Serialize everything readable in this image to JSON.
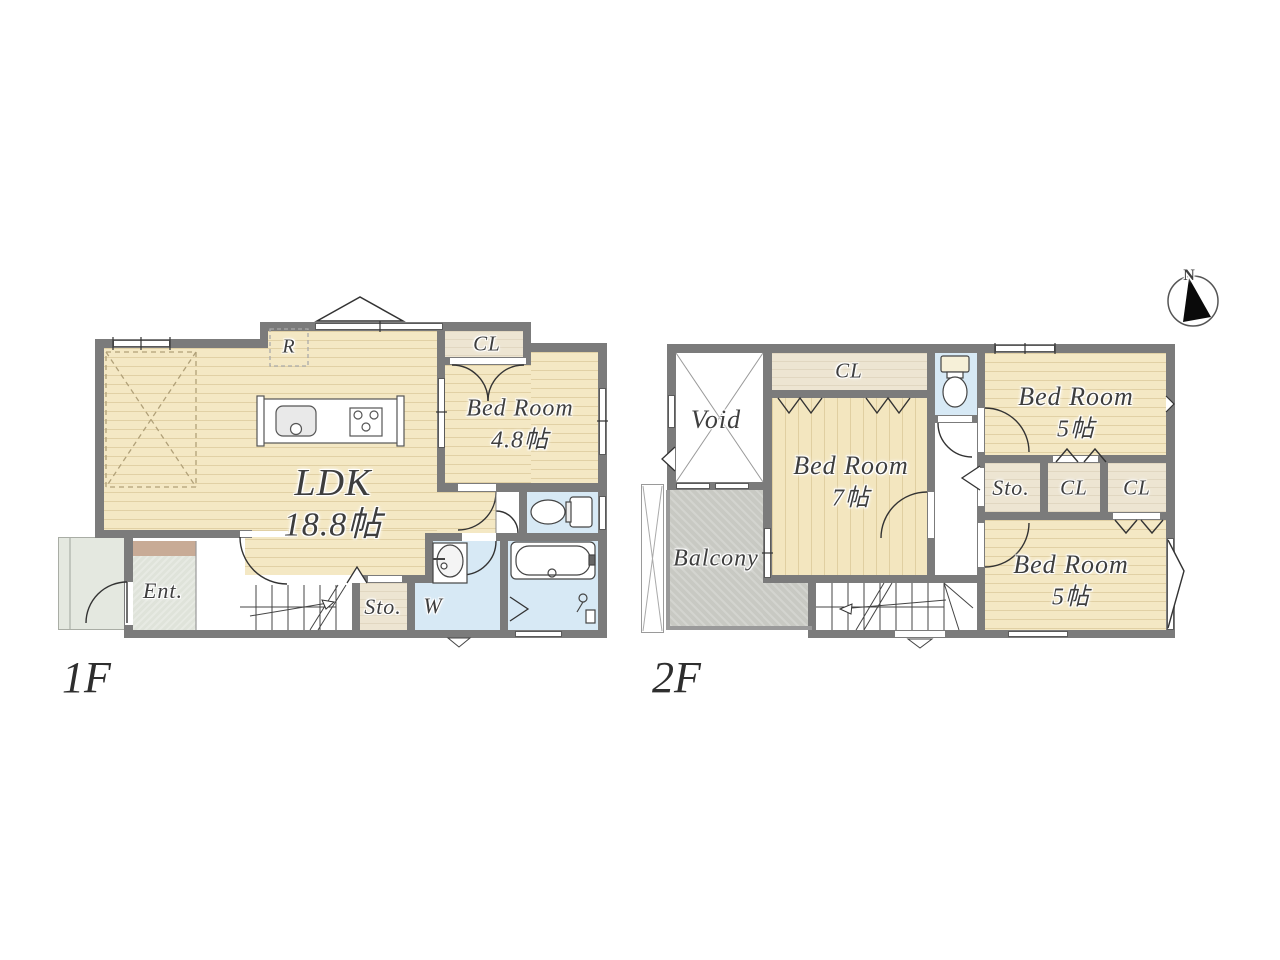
{
  "canvas": {
    "background": "#ffffff"
  },
  "compass": {
    "north_label": "N"
  },
  "colors": {
    "wall": "#7b7b7b",
    "wood_floor": "#f4e8c4",
    "closet_floor": "#ede5d2",
    "water_area": "#d7e9f5",
    "balcony": "#c8c9c3",
    "entrance_stone": "#dfe3da",
    "entrance_step": "#c8ab96"
  },
  "floor_1f": {
    "floor_label": "1F",
    "ldk": {
      "name": "LDK",
      "size": "18.8帖"
    },
    "bedroom": {
      "name": "Bed Room",
      "size": "4.8帖"
    },
    "closet_label": "CL",
    "refrigerator_label": "R",
    "entrance_label": "Ent.",
    "storage_label": "Sto.",
    "washer_label": "W"
  },
  "floor_2f": {
    "floor_label": "2F",
    "void_label": "Void",
    "balcony_label": "Balcony",
    "closet_top_label": "CL",
    "bedroom_7": {
      "name": "Bed Room",
      "size": "7帖"
    },
    "bedroom_5_north": {
      "name": "Bed Room",
      "size": "5帖"
    },
    "bedroom_5_south": {
      "name": "Bed Room",
      "size": "5帖"
    },
    "storage_label": "Sto.",
    "closet_1_label": "CL",
    "closet_2_label": "CL"
  }
}
